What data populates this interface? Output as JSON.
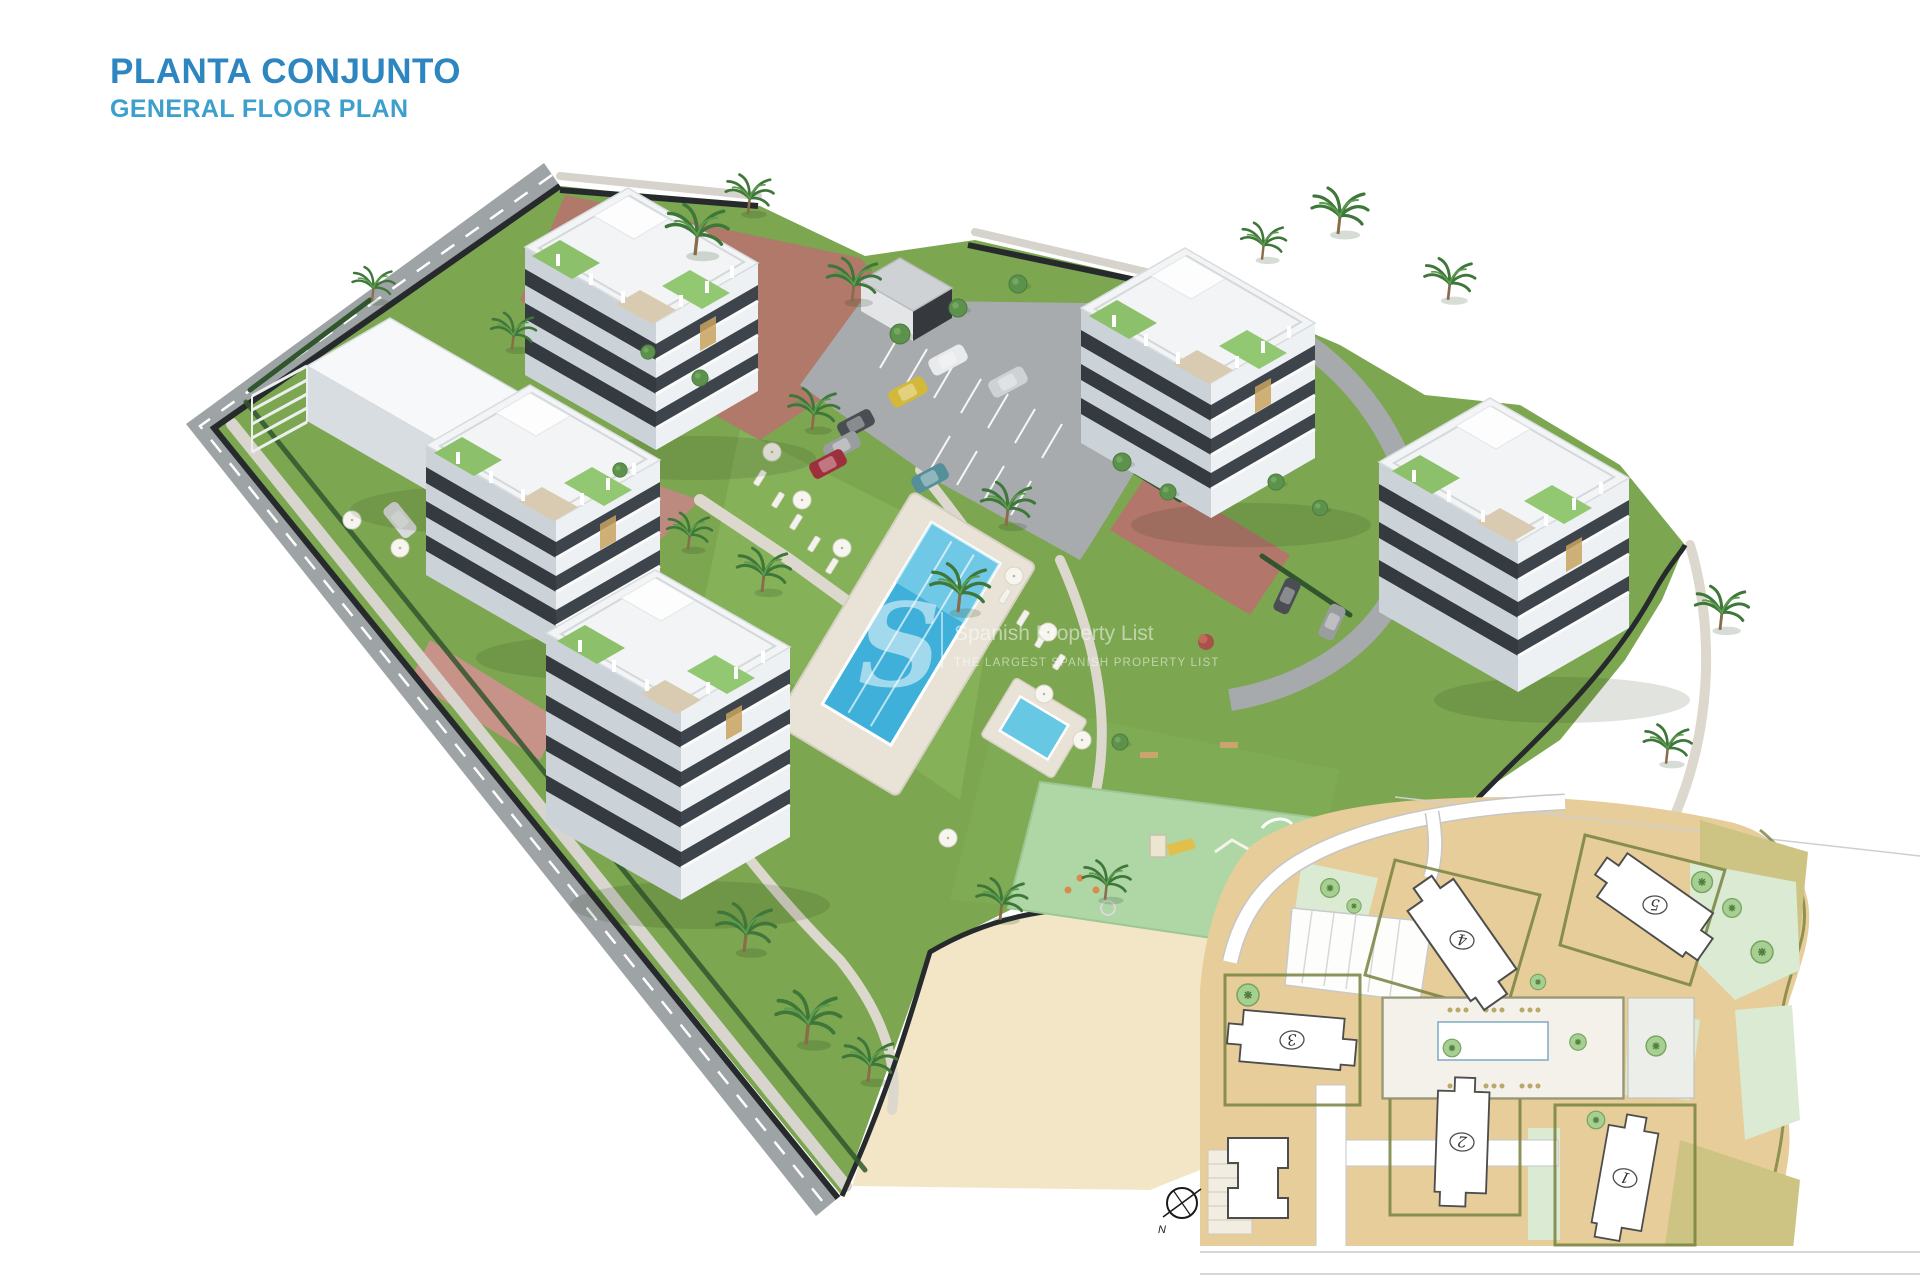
{
  "header": {
    "title": "PLANTA CONJUNTO",
    "subtitle": "GENERAL FLOOR PLAN"
  },
  "watermark": {
    "logo_letter": "S",
    "line1": "Spanish Property List",
    "line2": "THE LARGEST SPANISH PROPERTY LIST"
  },
  "inset": {
    "compass_label": "N",
    "buildings": [
      {
        "label": "1"
      },
      {
        "label": "2"
      },
      {
        "label": "3"
      },
      {
        "label": "4"
      },
      {
        "label": "5"
      }
    ]
  },
  "colors": {
    "title_blue": "#2E86C1",
    "subtitle_blue": "#3D9FCC",
    "grass_green": "#7CA64F",
    "pool_blue": "#3FB0DA",
    "kids_pool_blue": "#66C8E2",
    "playground_green": "#AFD7A6",
    "paving_pink": "#B3766B",
    "sand_cream": "#F2E6C6",
    "asphalt_gray": "#9EA3A6",
    "boundary_dark": "#272A2D",
    "plan_sand": "#E7CD9A",
    "plan_olive": "#77823F",
    "plan_leaf": "#DAEAD3"
  }
}
